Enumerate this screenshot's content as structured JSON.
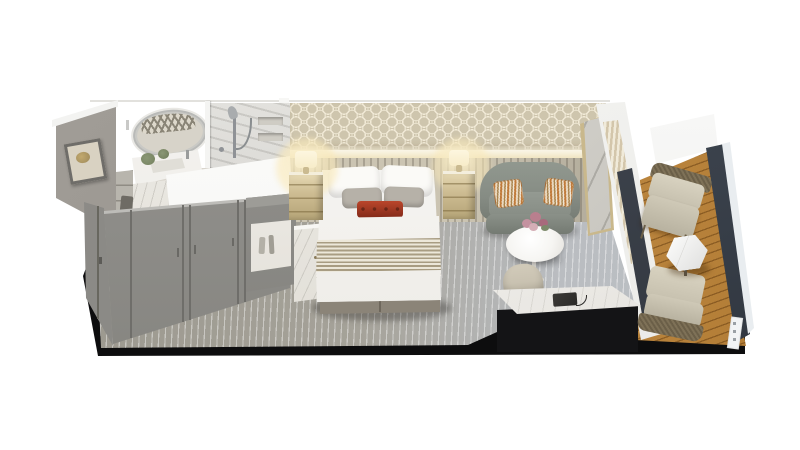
{
  "scene": {
    "name": "stateroom-cutaway-floorplan-render",
    "areas": [
      "bathroom",
      "wardrobe-entry",
      "bedroom",
      "sitting-area",
      "desk-area",
      "balcony"
    ],
    "furniture": [
      "oval-vanity-mirror",
      "vanity-sink",
      "shower",
      "framed-artwork",
      "wardrobe",
      "minibar-cabinet",
      "marble-cabinet",
      "double-bed",
      "nightstand-left",
      "nightstand-right",
      "table-lamp-left",
      "table-lamp-right",
      "sofa",
      "round-side-table",
      "flower-bouquet",
      "desk",
      "telephone",
      "desk-chair",
      "sliding-glass-door",
      "leaning-mirror",
      "balcony-chair-upper",
      "balcony-chair-lower",
      "balcony-hex-table",
      "balcony-railing"
    ]
  },
  "colors": {
    "background": "#ffffff",
    "slab": "#0d0d0e",
    "carpet_warm": "#9a978d",
    "carpet_mid": "#a5a299",
    "carpet_cool": "#babdc1",
    "band_base": "#cec5ad",
    "band_pattern": "#f0e9d4",
    "cove_glow": "#f7f0da",
    "channel_light": "#cbc4b2",
    "channel_dark": "#a9a292",
    "wardrobe_gray": "#8f8e8a",
    "cabinet_gray": "#8b8a86",
    "art_wall": "#98948e",
    "marble_wall": "#e7e6e2",
    "shower_wall": "#dddcd8",
    "white_wall": "#f8f8f6",
    "bed_white": "#f3f2ef",
    "pillow_gray": "#b6b1a8",
    "pillow_red": "#a3351f",
    "blanket_stripe": "#a89c82",
    "blanket_base": "#ece7d9",
    "bed_base": "#8b8478",
    "nightstand_gold": "#cdbc92",
    "lamp_glow": "#f7ecc9",
    "sofa_body": "#868c84",
    "sofa_seat": "#949a92",
    "cushion_orange": "#c07a3a",
    "cushion_cream": "#f0e6d4",
    "table_white": "#f6f5f2",
    "flower_pink": "#c492a0",
    "desk_top": "#edebe7",
    "phone_black": "#2b2a28",
    "chair_beige": "#c9c2b1",
    "deck_light": "#c08b44",
    "deck_dark": "#a96a24",
    "wicker_frame": "#7e7157",
    "railing_dark": "#39404a",
    "railing_trim": "#e9edf0",
    "glass_dark": "#2e333b",
    "curtain_tan": "#d3c6ab"
  }
}
